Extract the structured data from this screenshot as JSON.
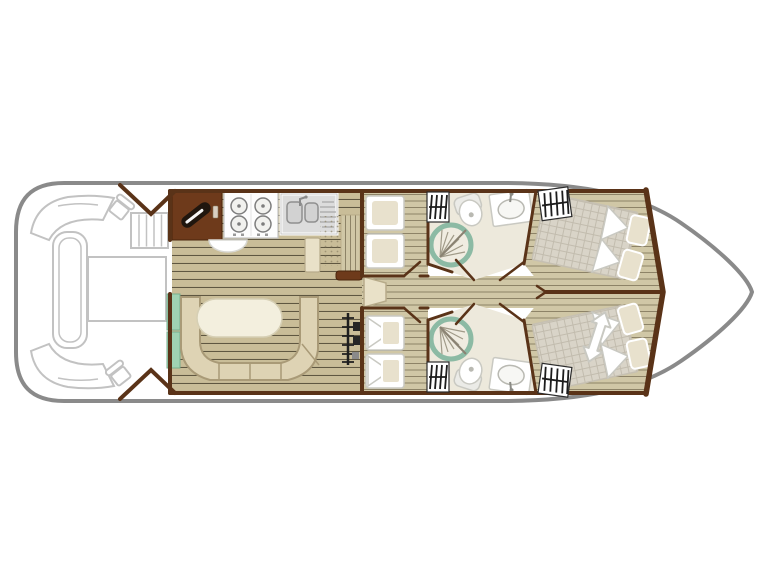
{
  "meta": {
    "type": "boat-floor-plan-diagram",
    "visible_text": ""
  },
  "colors": {
    "background": "#ffffff",
    "hull_stroke": "#8a8a8a",
    "wall": "#5a3318",
    "wood_base": "#c9bd98",
    "wood_line": "#5f5741",
    "wood2_base": "#d0c7a6",
    "wood2_line": "#8d8367",
    "bathroom_floor": "#ede9dc",
    "shower_ring": "#8cbaa4",
    "shower_face": "#f0ece1",
    "shower_fan": "#a09a88",
    "bench_fill": "#ded3b4",
    "bench_stroke": "#a99a77",
    "table_fill": "#f3efde",
    "table_stroke": "#d6cfb4",
    "mint": "#9fd2b3",
    "cabinet_brown": "#6e3a1b",
    "appliance_dark": "#20160e",
    "fixture_stroke": "#c9c9c2",
    "pillow": "#e8e1cd",
    "quilt_base": "#d9d4c8",
    "quilt_line": "#c2bcae",
    "deck_stroke": "#c2c2c2",
    "hatch": "#1c1c1c"
  },
  "plan": {
    "areas": [
      {
        "name": "aft-deck",
        "fixtures": [
          "corner-bench-port",
          "corner-bench-starboard",
          "side-bench",
          "deck-table",
          "helm-seat-port",
          "helm-seat-starboard",
          "entry-steps",
          "entry-doors"
        ]
      },
      {
        "name": "saloon-galley",
        "fixtures": [
          "worktop-cabinet",
          "hob-4-burner",
          "double-sink-drainer",
          "half-round-table",
          "tall-cabinet",
          "rug",
          "shelf",
          "companionway-steps"
        ]
      },
      {
        "name": "dinette",
        "fixtures": [
          "u-bench",
          "oval-table",
          "mint-sideboard"
        ]
      },
      {
        "name": "mid-cabin-port",
        "fixtures": [
          "twin-beds",
          "wardrobe"
        ]
      },
      {
        "name": "mid-cabin-starboard",
        "fixtures": [
          "twin-beds",
          "wardrobe"
        ]
      },
      {
        "name": "bathroom-port",
        "fixtures": [
          "round-shower",
          "toilet",
          "washbasin",
          "door"
        ]
      },
      {
        "name": "bathroom-starboard",
        "fixtures": [
          "round-shower",
          "toilet",
          "washbasin",
          "door"
        ]
      },
      {
        "name": "bow-cabin-port",
        "fixtures": [
          "double-bed-angled",
          "pillows",
          "wardrobe"
        ]
      },
      {
        "name": "bow-cabin-starboard",
        "fixtures": [
          "double-bed-angled",
          "pillows",
          "wardrobe",
          "convertible-arrow"
        ]
      },
      {
        "name": "bow-deck",
        "fixtures": []
      }
    ],
    "corridor": "central-corridor"
  }
}
